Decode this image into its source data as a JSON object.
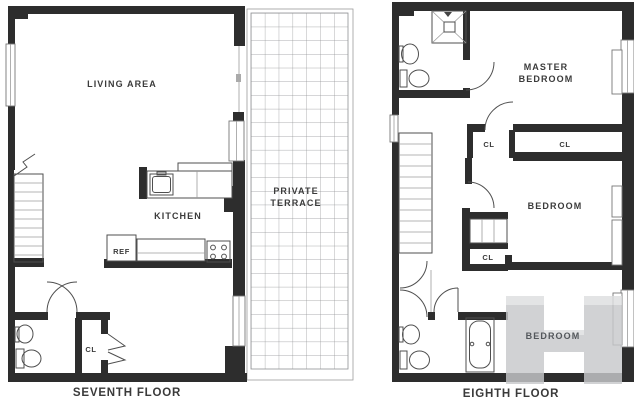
{
  "colors": {
    "wall": "#2d2d2d",
    "line": "#4f4f4f",
    "light_line": "#9b9b9b",
    "grid": "#8f9193",
    "label": "#3b3b3b",
    "caption": "#3a3a3a",
    "watermark": "#c7c9cb",
    "watermark_hi": "#dddfe0",
    "lower_label": "#53575b"
  },
  "seventh_floor": {
    "caption": "SEVENTH FLOOR",
    "labels": {
      "living_area": "LIVING AREA",
      "kitchen": "KITCHEN",
      "refrigerator": "REF",
      "closet": "CL",
      "terrace_line1": "PRIVATE",
      "terrace_line2": "TERRACE"
    }
  },
  "eighth_floor": {
    "caption": "EIGHTH FLOOR",
    "labels": {
      "master_bedroom_line1": "MASTER",
      "master_bedroom_line2": "BEDROOM",
      "closet_left": "CL",
      "closet_right": "CL",
      "bedroom": "BEDROOM",
      "closet_small": "CL",
      "bedroom_lower": "BEDROOM"
    }
  }
}
